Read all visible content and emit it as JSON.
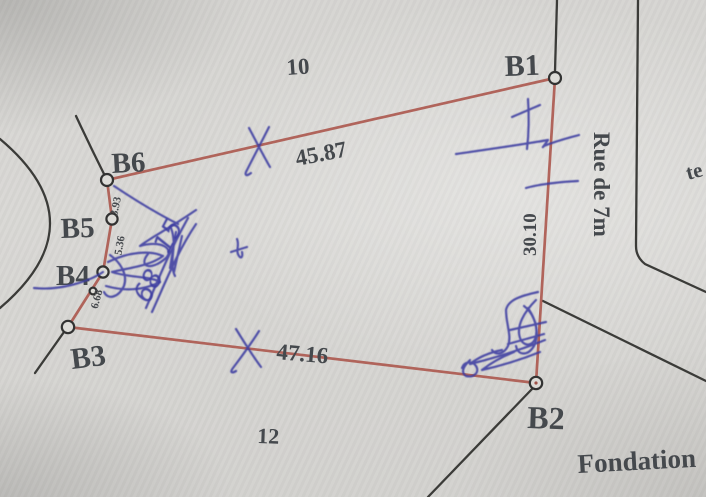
{
  "plan": {
    "points": {
      "b1": "B1",
      "b2": "B2",
      "b3": "B3",
      "b4": "B4",
      "b5": "B5",
      "b6": "B6"
    },
    "parcel_numbers": {
      "top": "10",
      "bottom": "12"
    },
    "measurements": {
      "b6_b1": "45.87",
      "b3_b2": "47.16",
      "b1_b2": "30.10",
      "b6_b5": "3.93",
      "b5_b4": "5.36",
      "b4_b3": "6.68"
    },
    "street_label": "Rue de 7m",
    "foundation_label": "Fondation",
    "right_edge_partial_label": "te",
    "handwriting": {
      "upper_digits": "15",
      "lower_digits": "68"
    },
    "colors": {
      "paper": "#d8d7d4",
      "boundary_red": "#ac5a50",
      "parcel_line_black": "#3a3b39",
      "printed_text": "#45484d",
      "pen_blue": "#3c3da1"
    }
  }
}
